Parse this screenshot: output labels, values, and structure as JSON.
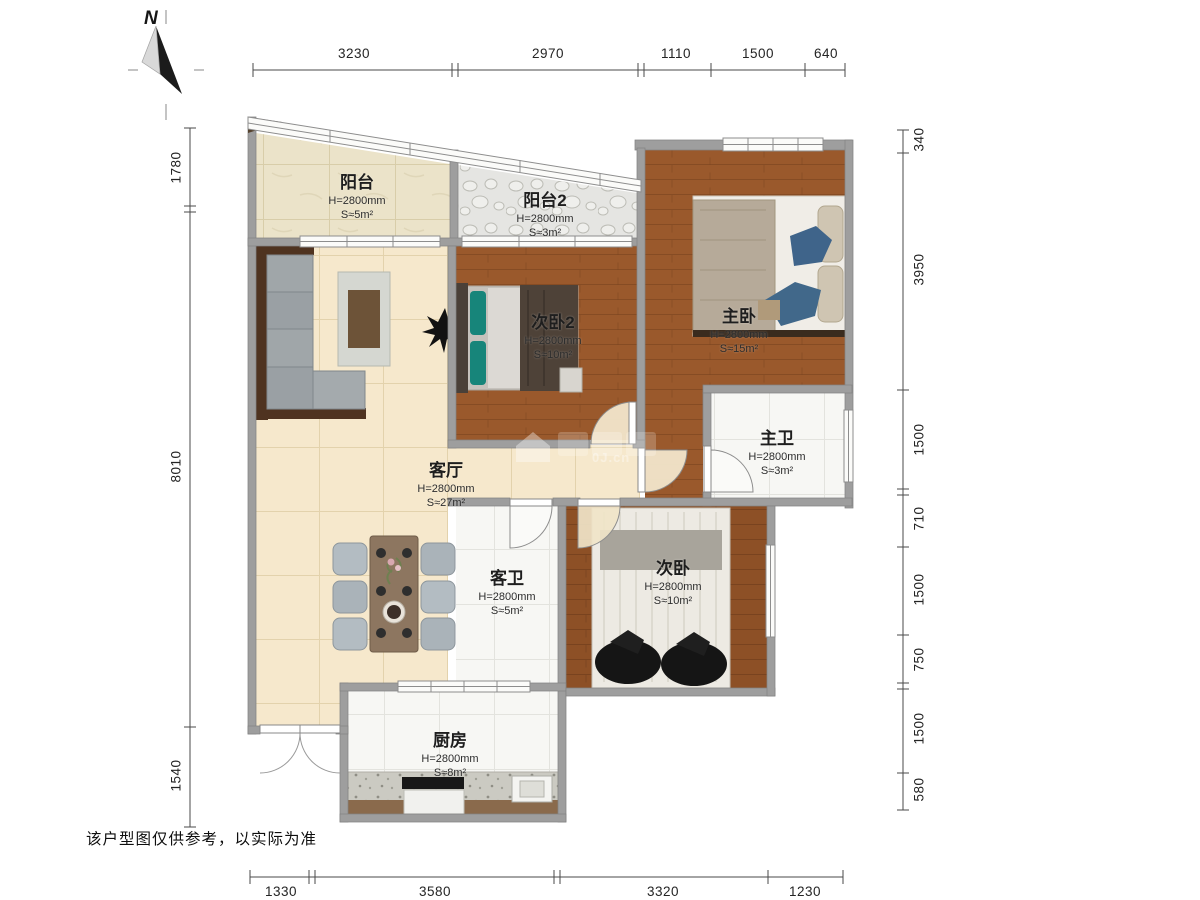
{
  "meta": {
    "compass_label": "N",
    "disclaimer": "该户型图仅供参考，以实际为准",
    "watermark": "0J.cn"
  },
  "rooms": {
    "balcony": {
      "name": "阳台",
      "height": "H=2800mm",
      "area": "S≈5m²"
    },
    "balcony2": {
      "name": "阳台2",
      "height": "H=2800mm",
      "area": "S≈3m²"
    },
    "master": {
      "name": "主卧",
      "height": "H=2800mm",
      "area": "S≈15m²"
    },
    "bedroom2": {
      "name": "次卧2",
      "height": "H=2800mm",
      "area": "S≈10m²"
    },
    "living": {
      "name": "客厅",
      "height": "H=2800mm",
      "area": "S≈27m²"
    },
    "master_bath": {
      "name": "主卫",
      "height": "H=2800mm",
      "area": "S≈3m²"
    },
    "guest_bath": {
      "name": "客卫",
      "height": "H=2800mm",
      "area": "S≈5m²"
    },
    "bedroom": {
      "name": "次卧",
      "height": "H=2800mm",
      "area": "S≈10m²"
    },
    "kitchen": {
      "name": "厨房",
      "height": "H=2800mm",
      "area": "S≈8m²"
    }
  },
  "dimensions": {
    "top": [
      "3230",
      "2970",
      "1110",
      "1500",
      "640"
    ],
    "bottom": [
      "1330",
      "3580",
      "3320",
      "1230"
    ],
    "left": [
      "1780",
      "8010",
      "1540"
    ],
    "right": [
      "340",
      "3950",
      "1500",
      "710",
      "1500",
      "750",
      "1500",
      "580"
    ]
  },
  "colors": {
    "wall": "#9e9e9e",
    "wood_floor": "#9a592c",
    "living_tile": "#f6e8cc",
    "bath_tile": "#f7f7f4",
    "dimension_text": "#242424"
  }
}
